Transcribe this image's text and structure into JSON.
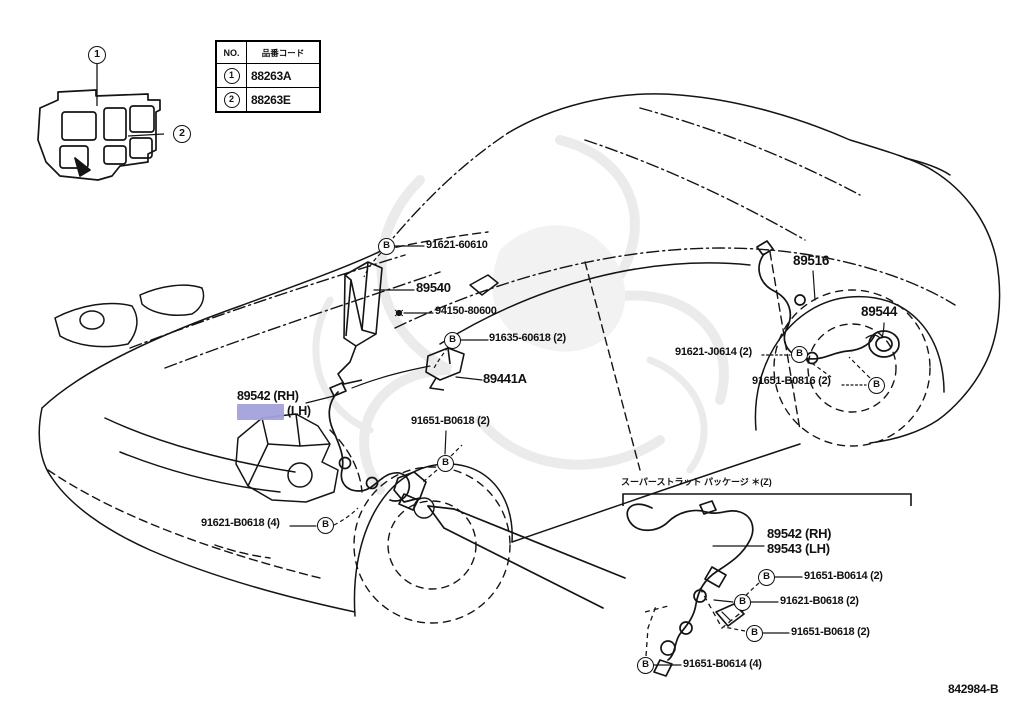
{
  "doc": {
    "code": "842984-B"
  },
  "colors": {
    "highlight": "#a2a2db",
    "line": "#141414",
    "watermark": "#a8a8a8"
  },
  "legend_table": {
    "col_no": "NO.",
    "col_code": "品番コード",
    "rows": [
      {
        "no": "1",
        "code": "88263A"
      },
      {
        "no": "2",
        "code": "88263E"
      }
    ]
  },
  "callouts": {
    "one": "1",
    "two": "2"
  },
  "bolt": "B",
  "main_labels": {
    "l_91621_60610": "91621-60610",
    "l_89540": "89540",
    "l_94150_80600": "94150-80600",
    "l_91635_60618": "91635-60618 (2)",
    "l_89441a": "89441A",
    "l_89542_rh": "89542 (RH)",
    "l_89543_lh_suffix": "(LH)",
    "l_91651_b0618_front": "91651-B0618 (2)",
    "l_91621_b0618_front": "91621-B0618 (4)",
    "l_89516": "89516",
    "l_89544": "89544",
    "l_91621_j0614": "91621-J0614 (2)",
    "l_91651_b0816": "91651-B0816 (2)"
  },
  "detail": {
    "header": "スーパーストラット パッケージ ＊(Z)",
    "d_89542_rh": "89542 (RH)",
    "d_89543_lh": "89543 (LH)",
    "d_91651_b0614_2": "91651-B0614 (2)",
    "d_91621_b0618_2": "91621-B0618 (2)",
    "d_91651_b0618_2": "91651-B0618 (2)",
    "d_91651_b0614_4": "91651-B0614 (4)"
  }
}
